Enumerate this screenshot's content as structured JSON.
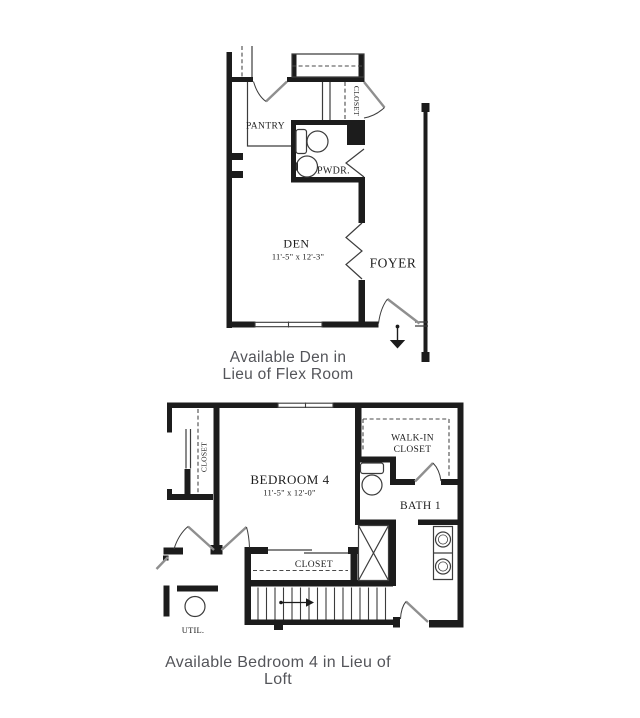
{
  "plan_den": {
    "caption": {
      "line1": "Available Den in",
      "line2": "Lieu of Flex Room"
    },
    "labels": {
      "pantry": "PANTRY",
      "closet": "CLOSET",
      "powder": "PWDR.",
      "den": "DEN",
      "den_dims": "11'-5\" x 12'-3\"",
      "foyer": "FOYER"
    }
  },
  "plan_bedroom4": {
    "caption": "Available Bedroom 4 in Lieu of Loft",
    "labels": {
      "closet_left": "CLOSET",
      "bedroom": "BEDROOM 4",
      "bedroom_dims": "11'-5\" x 12'-0\"",
      "walkin_line1": "WALK-IN",
      "walkin_line2": "CLOSET",
      "bath": "BATH 1",
      "closet_bottom": "CLOSET",
      "utility": "UTIL."
    }
  },
  "colors": {
    "wall": "#1c1c1c",
    "thin_line": "#3c3c3c",
    "door_leaf": "#8f8f8f",
    "label_text": "#1d1d1d",
    "caption_text": "#54555a",
    "background": "#ffffff"
  }
}
